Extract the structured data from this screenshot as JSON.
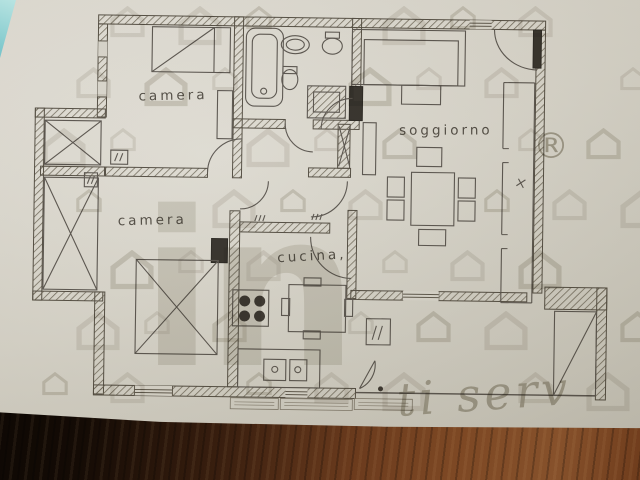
{
  "scene": {
    "type": "photo of an architectural floor plan lying on a dark wooden table",
    "colors": {
      "paper": "#d8d5cb",
      "ink": "#4e483d",
      "watermark_gray": "#aaa596",
      "wood_brown": "#6b3b1d",
      "shadow_black": "#0b0704",
      "teal_corner": "#8fd0d2"
    }
  },
  "plan": {
    "rooms": [
      {
        "id": "camera-1",
        "label": "camera"
      },
      {
        "id": "camera-2",
        "label": "camera"
      },
      {
        "id": "soggiorno",
        "label": "soggiorno"
      },
      {
        "id": "cucina",
        "label": "cucina,"
      }
    ],
    "fixtures": [
      "bed",
      "wardrobe",
      "bathtub",
      "washbasin",
      "wc",
      "bidet",
      "shower",
      "sofa",
      "coffee-table",
      "tv-unit",
      "dining-table",
      "chairs",
      "stove",
      "kitchen-table",
      "kitchen-sink",
      "radiators",
      "balcony",
      "terrace",
      "entrance-door"
    ]
  },
  "watermark": {
    "logo_text": "in",
    "registered_mark": "®",
    "slogan_script": "ti serv",
    "pattern_icon": "house-icon"
  }
}
